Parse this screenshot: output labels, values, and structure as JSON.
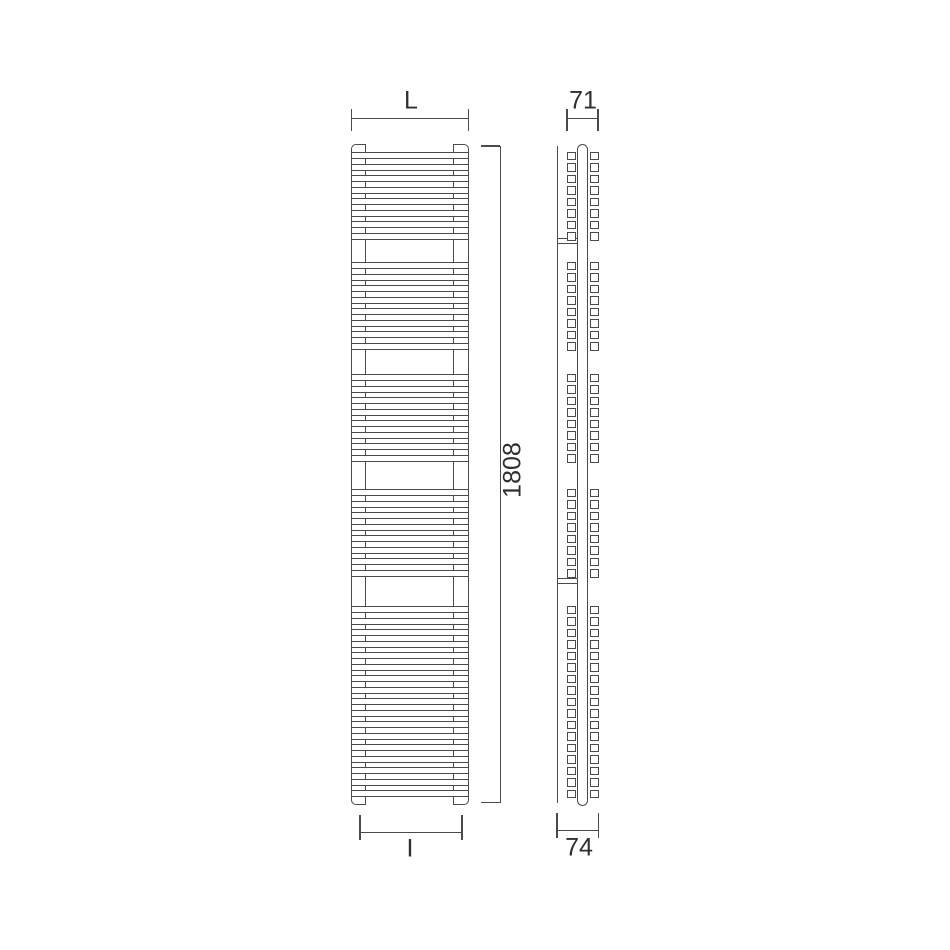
{
  "labels": {
    "width": "L",
    "depth_top": "71",
    "height": "1808",
    "interaxis": "I",
    "depth_bottom": "74"
  },
  "colors": {
    "line": "#4a4a4a",
    "text": "#2f2f2f",
    "background": "#ffffff"
  },
  "diagram": {
    "front": {
      "x": 351,
      "width": 118,
      "top": 144,
      "bottom": 805,
      "collector_left_w": 15,
      "collector_right_w": 16,
      "bar_height": 7,
      "period": 11.5,
      "groups": [
        {
          "start": 152,
          "count": 8
        },
        {
          "start": 262,
          "count": 8
        },
        {
          "start": 374,
          "count": 8
        },
        {
          "start": 489,
          "count": 8
        },
        {
          "start": 606,
          "count": 17
        }
      ]
    },
    "side": {
      "wall_x": 557,
      "wall_top": 146,
      "wall_bottom": 803,
      "tube_x": 576.5,
      "tube_w": 11.5,
      "tube_top": 144,
      "tube_bottom": 806,
      "square_w": 9.5,
      "square_h": 8.5,
      "left_square_x": 566.5,
      "right_square_x": 589.5,
      "bracket_y": [
        238,
        578
      ],
      "bracket_h": 5.5
    },
    "dims": {
      "width": {
        "line_y": 118,
        "x1": 351.5,
        "x2": 468.5,
        "tick_dy": -9,
        "tick_h": 22,
        "label_x": 411,
        "label_y": 101
      },
      "depth_top": {
        "line_y": 118,
        "x1": 567,
        "x2": 598,
        "tick_dy": -9,
        "tick_h": 22,
        "label_x": 583,
        "label_y": 101
      },
      "height": {
        "line_x": 500,
        "y1": 146,
        "y2": 802.5,
        "serif_len": 19,
        "label_x": 513,
        "label_y": 470
      },
      "interaxis": {
        "line_y": 831.5,
        "x1": 360,
        "x2": 462,
        "tick_dy": -17,
        "tick_h": 25,
        "label_x": 410,
        "label_y": 849
      },
      "depth_bottom": {
        "line_y": 830,
        "x1": 557,
        "x2": 598.5,
        "tick_dy": -17,
        "tick_h": 25,
        "label_x": 579,
        "label_y": 848
      }
    }
  }
}
